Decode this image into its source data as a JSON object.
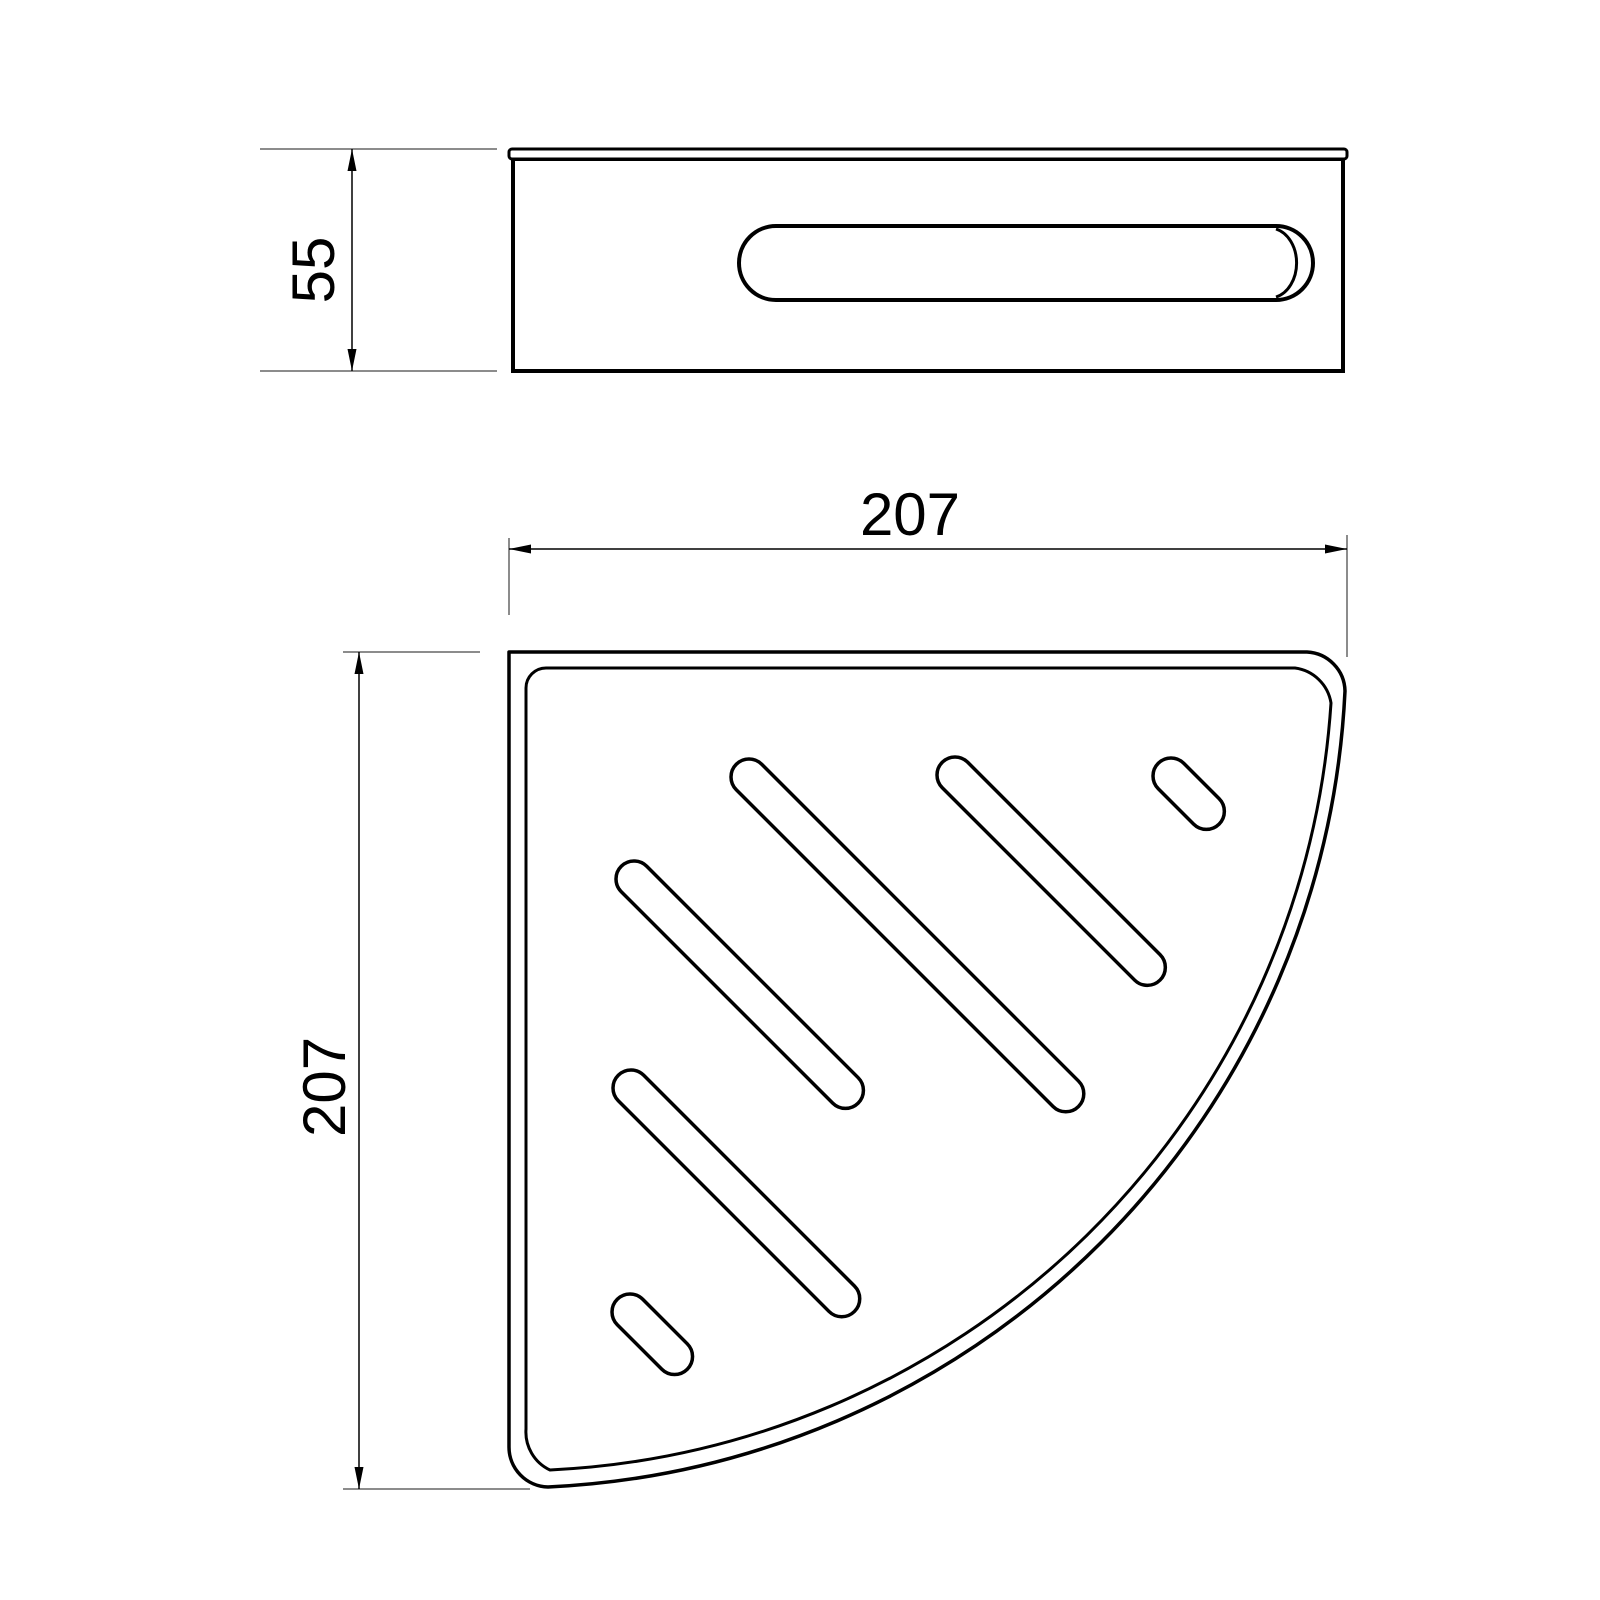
{
  "drawing": {
    "type": "technical-dimension-drawing",
    "product": "corner-basket-shelf",
    "dimensions": {
      "side_height": "55",
      "plan_width": "207",
      "plan_height": "207"
    },
    "colors": {
      "line": "#000000",
      "extension_line": "#666666",
      "background": "#ffffff"
    }
  }
}
